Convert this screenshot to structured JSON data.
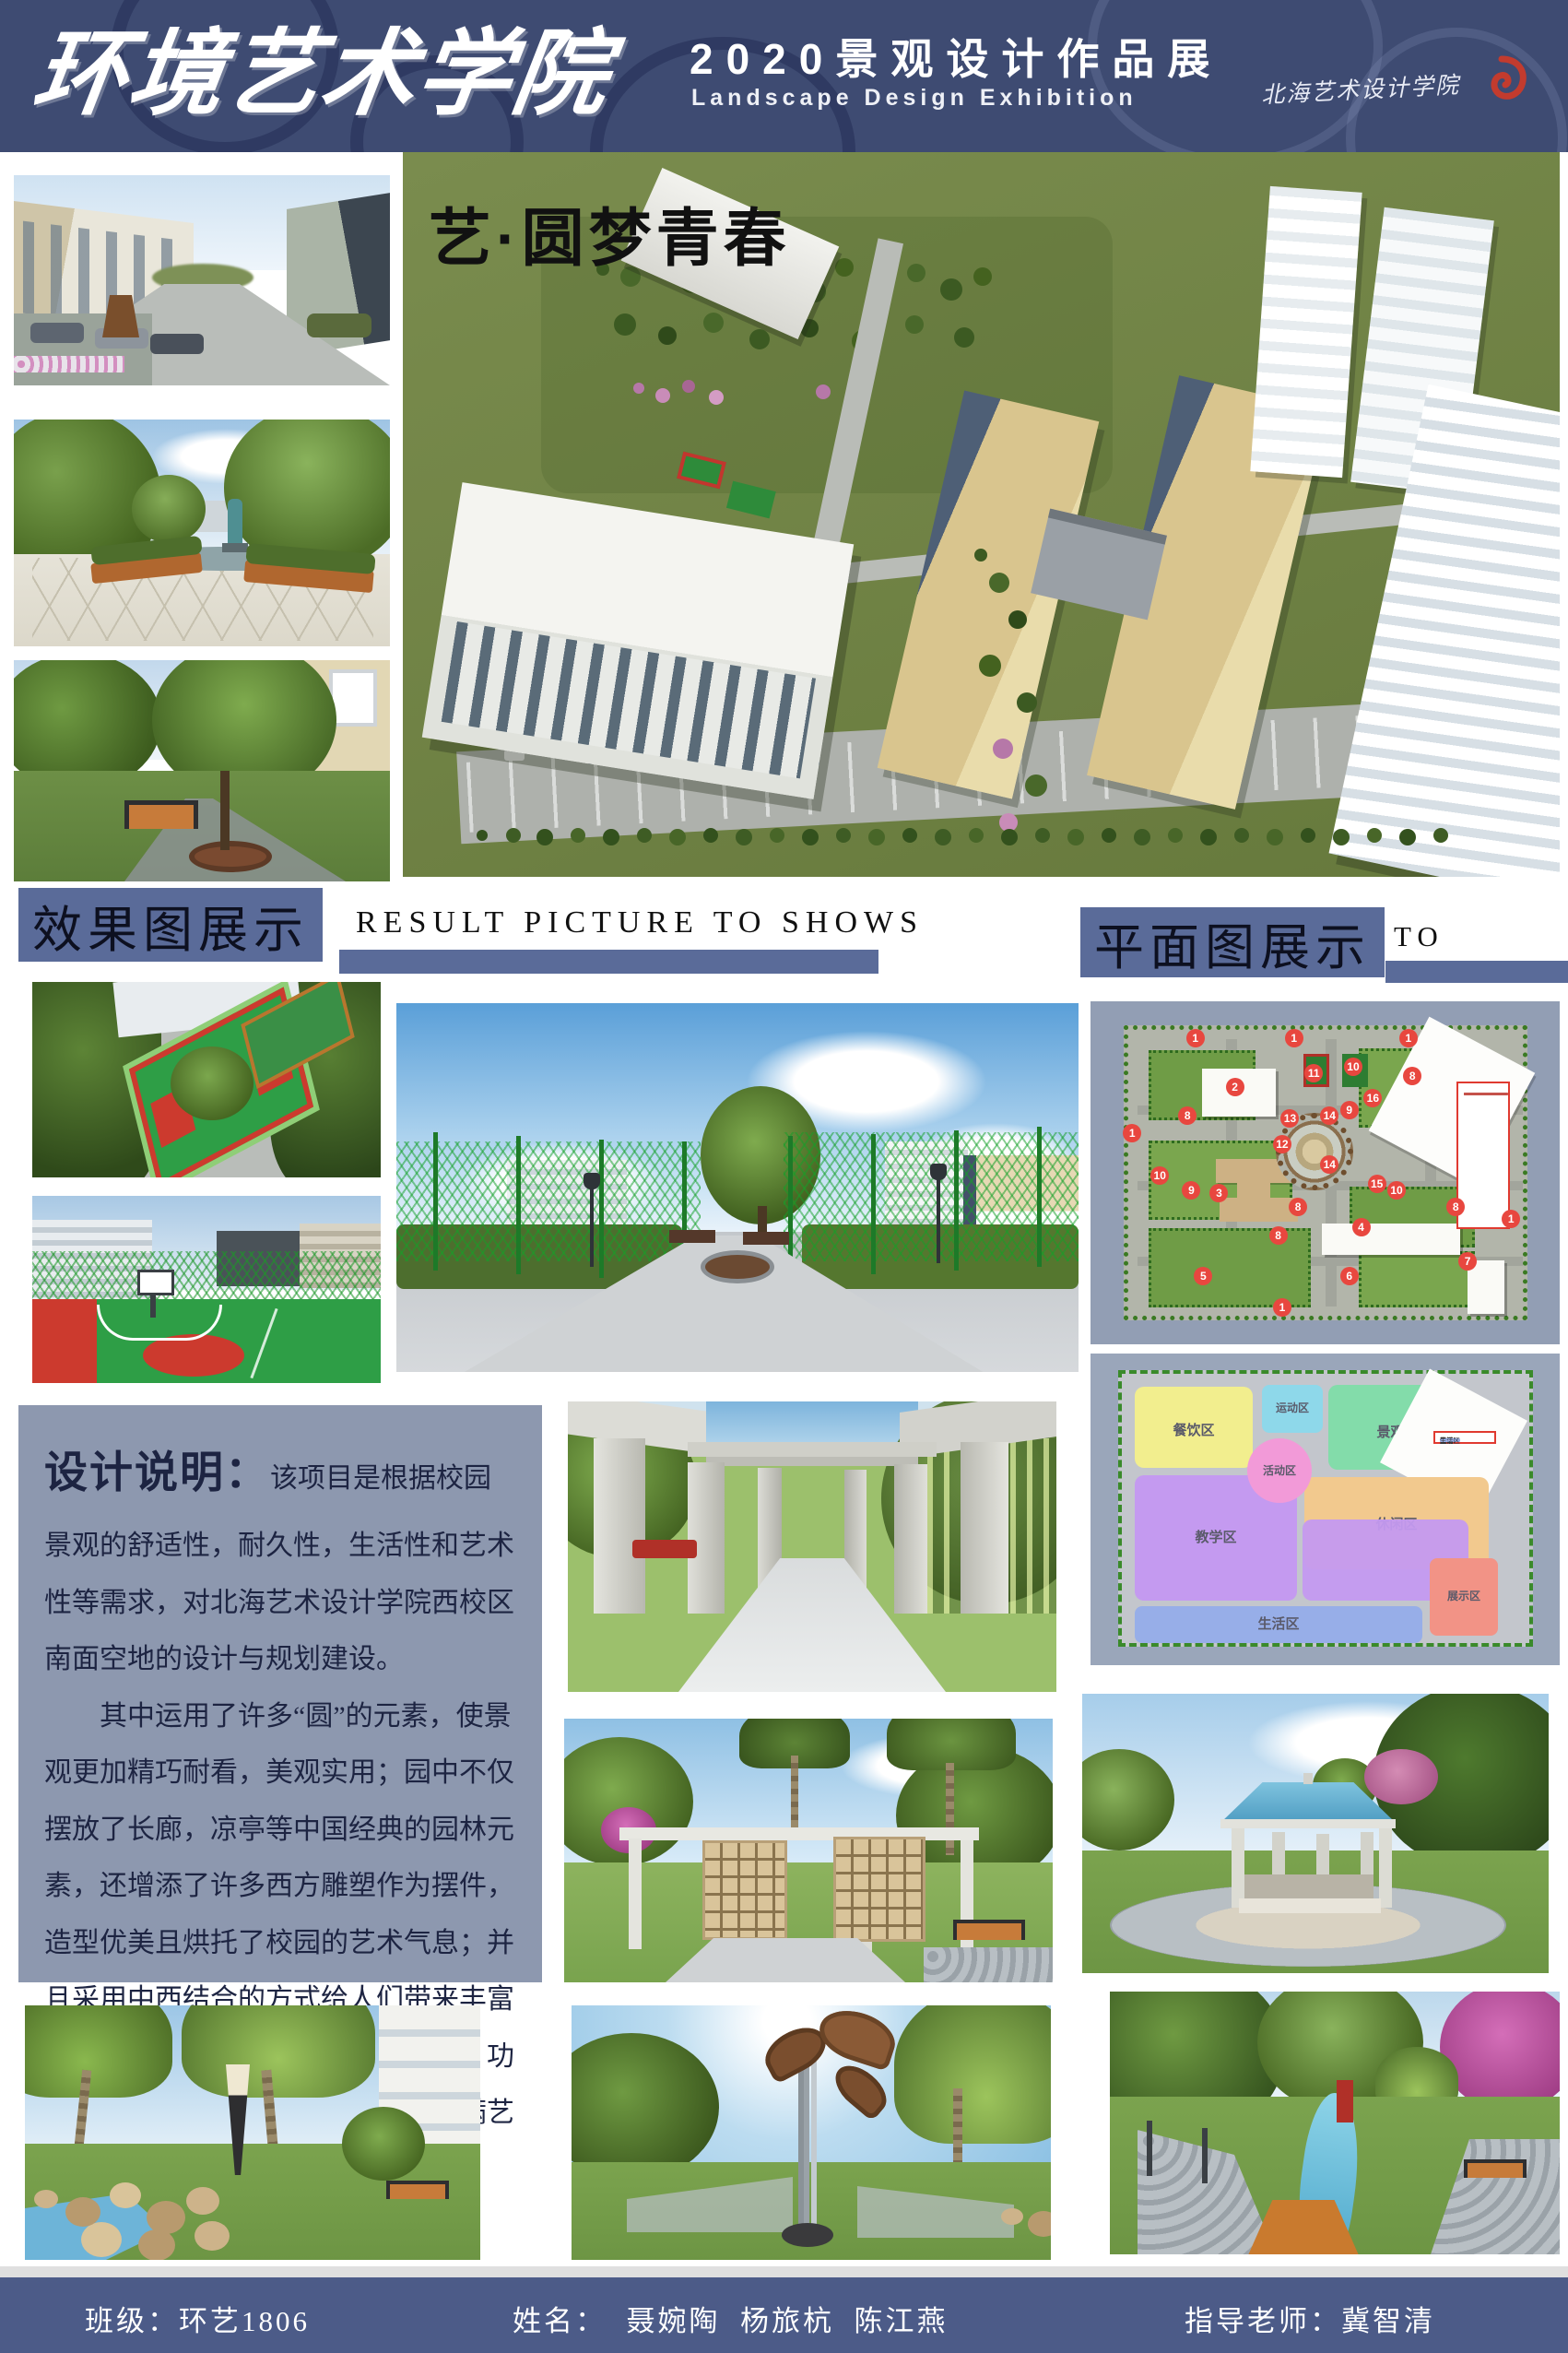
{
  "header": {
    "calligraphy_title": "环境艺术学院",
    "exhibition_title": "2020景观设计作品展",
    "exhibition_subtitle": "Landscape Design Exhibition",
    "school_signature": "北海艺术设计学院"
  },
  "hero": {
    "slogan": "艺·圆梦青春"
  },
  "sections": {
    "results": {
      "title": "效果图展示",
      "caption": "RESULT PICTURE TO SHOWS"
    },
    "plans": {
      "title": "平面图展示",
      "caption": "TO SHOWS"
    }
  },
  "design_note": {
    "title": "设计说明：",
    "paragraph1": "该项目是根据校园景观的舒适性，耐久性，生活性和艺术性等需求，对北海艺术设计学院西校区南面空地的设计与规划建设。",
    "paragraph2": "其中运用了许多“圆”的元素，使景观更加精巧耐看，美观实用；园中不仅摆放了长廊，凉亭等中国经典的园林元素，还增添了许多西方雕塑作为摆件，造型优美且烘托了校园的艺术气息；并且采用中西结合的方式给人们带来丰富的视觉体验。打造了一个布局合理，功能齐全，交通便利，环境优美且充满艺术气息的校园景观。"
  },
  "site_plan": {
    "legend_line_count": 16,
    "badges": [
      {
        "n": "1",
        "x": 17,
        "y": 3
      },
      {
        "n": "1",
        "x": 42,
        "y": 3
      },
      {
        "n": "1",
        "x": 71,
        "y": 3
      },
      {
        "n": "1",
        "x": 1,
        "y": 36
      },
      {
        "n": "1",
        "x": 39,
        "y": 97
      },
      {
        "n": "1",
        "x": 97,
        "y": 66
      },
      {
        "n": "2",
        "x": 27,
        "y": 20
      },
      {
        "n": "3",
        "x": 23,
        "y": 57
      },
      {
        "n": "4",
        "x": 59,
        "y": 69
      },
      {
        "n": "5",
        "x": 19,
        "y": 86
      },
      {
        "n": "6",
        "x": 56,
        "y": 86
      },
      {
        "n": "7",
        "x": 86,
        "y": 81
      },
      {
        "n": "8",
        "x": 15,
        "y": 30
      },
      {
        "n": "8",
        "x": 72,
        "y": 16
      },
      {
        "n": "8",
        "x": 43,
        "y": 62
      },
      {
        "n": "8",
        "x": 38,
        "y": 72
      },
      {
        "n": "8",
        "x": 83,
        "y": 62
      },
      {
        "n": "9",
        "x": 56,
        "y": 28
      },
      {
        "n": "9",
        "x": 16,
        "y": 56
      },
      {
        "n": "10",
        "x": 57,
        "y": 13
      },
      {
        "n": "10",
        "x": 8,
        "y": 51
      },
      {
        "n": "10",
        "x": 68,
        "y": 56
      },
      {
        "n": "11",
        "x": 47,
        "y": 15
      },
      {
        "n": "12",
        "x": 39,
        "y": 40
      },
      {
        "n": "13",
        "x": 41,
        "y": 31
      },
      {
        "n": "14",
        "x": 51,
        "y": 30
      },
      {
        "n": "14",
        "x": 51,
        "y": 47
      },
      {
        "n": "15",
        "x": 63,
        "y": 54
      },
      {
        "n": "16",
        "x": 62,
        "y": 24
      }
    ]
  },
  "zone_plan": {
    "zones": [
      {
        "label": "餐饮区",
        "color": "#f2ee8e"
      },
      {
        "label": "运动区",
        "color": "#8ed8ea"
      },
      {
        "label": "景观区",
        "color": "#83dcaa"
      },
      {
        "label": "活动区",
        "color": "#f29ad8"
      },
      {
        "label": "教学区",
        "color": "#c49af0"
      },
      {
        "label": "休闲区",
        "color": "#f2c98e"
      },
      {
        "label": "展示区",
        "color": "#f29386"
      },
      {
        "label": "生活区",
        "color": "#97aee8"
      }
    ]
  },
  "footer": {
    "class_label": "班级：环艺1806",
    "names_label": "姓名：  聂婉陶  杨旅杭  陈江燕",
    "advisor_label": "指导老师：冀智清"
  },
  "colors": {
    "header_navy": "#3e4b72",
    "accent_blue": "#5a6b99",
    "footer_blue": "#4c5b88",
    "note_bg": "#8d98af",
    "badge_red": "#e8473f",
    "logo_red": "#c23b2e"
  }
}
